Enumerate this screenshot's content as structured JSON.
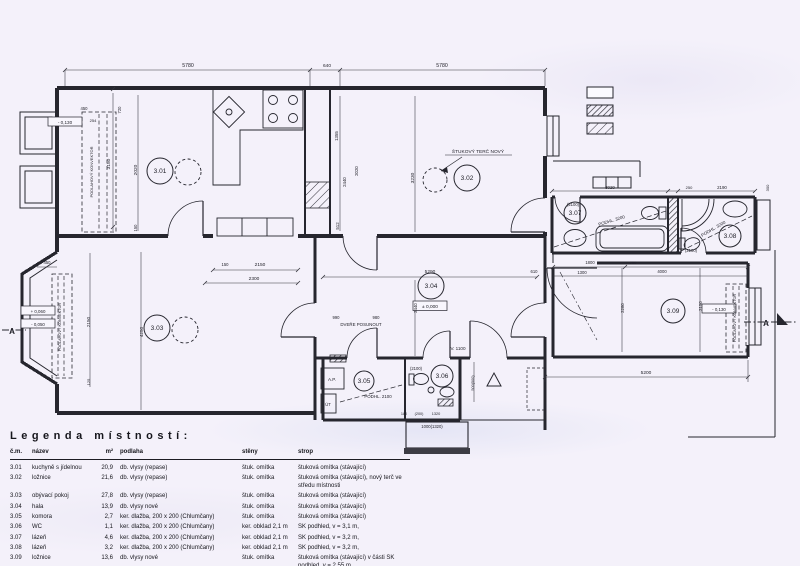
{
  "colors": {
    "background": "#f4f1fa",
    "ink": "#26262e",
    "dark_fill": "#3c3c44"
  },
  "plan": {
    "rooms": [
      {
        "num": "3.01",
        "x": 160,
        "y": 173,
        "r": 13
      },
      {
        "num": "3.02",
        "x": 467,
        "y": 180,
        "r": 13
      },
      {
        "num": "3.03",
        "x": 157,
        "y": 330,
        "r": 13
      },
      {
        "num": "3.04",
        "x": 431,
        "y": 288,
        "r": 13
      },
      {
        "num": "3.05",
        "x": 364,
        "y": 383,
        "r": 10
      },
      {
        "num": "3.06",
        "x": 442,
        "y": 378,
        "r": 11
      },
      {
        "num": "3.07",
        "x": 575,
        "y": 215,
        "r": 11
      },
      {
        "num": "3.08",
        "x": 730,
        "y": 238,
        "r": 11
      },
      {
        "num": "3.09",
        "x": 673,
        "y": 313,
        "r": 12
      }
    ],
    "texts": [
      {
        "n": "dim",
        "t": "5780",
        "x": 188,
        "y": 67
      },
      {
        "n": "dim",
        "t": "640",
        "x": 327,
        "y": 67,
        "s": 4.8
      },
      {
        "n": "dim",
        "t": "5780",
        "x": 442,
        "y": 67
      },
      {
        "n": "level-mark",
        "t": "- 0,130",
        "x": 65,
        "y": 124,
        "s": 4.6
      },
      {
        "n": "dim",
        "t": "450",
        "x": 84,
        "y": 110,
        "s": 4.2
      },
      {
        "n": "dim",
        "t": "254",
        "x": 93,
        "y": 122,
        "s": 4
      },
      {
        "n": "dim",
        "t": "720",
        "x": 121,
        "y": 110,
        "rot": -90,
        "s": 4.2
      },
      {
        "n": "dim",
        "t": "3150",
        "x": 110,
        "y": 164,
        "rot": -90,
        "s": 4.8
      },
      {
        "n": "dim",
        "t": "2020",
        "x": 137,
        "y": 170,
        "rot": -90,
        "s": 4.8
      },
      {
        "n": "dim",
        "t": "150",
        "x": 137,
        "y": 228,
        "rot": -90,
        "s": 4.2
      },
      {
        "n": "annotation",
        "t": "PODLAHOVÝ KONVEKTOR",
        "x": 93,
        "y": 172,
        "rot": -90,
        "s": 4
      },
      {
        "n": "dim",
        "t": "1355",
        "x": 338,
        "y": 136,
        "rot": -90,
        "s": 4.4
      },
      {
        "n": "dim",
        "t": "2440",
        "x": 346,
        "y": 182,
        "rot": -90,
        "s": 4.4
      },
      {
        "n": "dim",
        "t": "2020",
        "x": 358,
        "y": 171,
        "rot": -90,
        "s": 4.4
      },
      {
        "n": "dim",
        "t": "512",
        "x": 339,
        "y": 226,
        "rot": -90,
        "s": 4.4
      },
      {
        "n": "dim",
        "t": "3230",
        "x": 414,
        "y": 178,
        "rot": -90,
        "s": 4.8
      },
      {
        "n": "annotation",
        "t": "ŠTUKOVÝ TERČ NOVÝ",
        "x": 478,
        "y": 153,
        "s": 4.8
      },
      {
        "n": "dim",
        "t": "150",
        "x": 225,
        "y": 266,
        "s": 4.2
      },
      {
        "n": "dim",
        "t": "2150",
        "x": 260,
        "y": 266,
        "s": 4.8
      },
      {
        "n": "dim",
        "t": "2300",
        "x": 254,
        "y": 280,
        "s": 4.8
      },
      {
        "n": "dim",
        "t": "990",
        "x": 336,
        "y": 319,
        "s": 4.2
      },
      {
        "n": "dim",
        "t": "980",
        "x": 376,
        "y": 319,
        "s": 4.2
      },
      {
        "n": "annotation",
        "t": "DVEŘE POSUNOUT",
        "x": 361,
        "y": 326,
        "s": 4.4
      },
      {
        "n": "dim",
        "t": "5290",
        "x": 430,
        "y": 273,
        "s": 4.8
      },
      {
        "n": "dim",
        "t": "610",
        "x": 534,
        "y": 273,
        "s": 4.2
      },
      {
        "n": "dim",
        "t": "2440",
        "x": 417,
        "y": 308,
        "rot": -90,
        "s": 4.4
      },
      {
        "n": "level-mark",
        "t": "± 0,000",
        "x": 430,
        "y": 308,
        "s": 4.8
      },
      {
        "n": "annotation",
        "t": "V. 1100",
        "x": 458,
        "y": 350,
        "s": 4.6
      },
      {
        "n": "dim",
        "t": "(2100)",
        "x": 416,
        "y": 370,
        "s": 4.2
      },
      {
        "n": "annotation",
        "t": "PODHL. 2100",
        "x": 378,
        "y": 398,
        "s": 4.4
      },
      {
        "n": "dim",
        "t": "180",
        "x": 404,
        "y": 415,
        "s": 3.8
      },
      {
        "n": "dim",
        "t": "(200)",
        "x": 419,
        "y": 415,
        "s": 3.8
      },
      {
        "n": "dim",
        "t": "1320",
        "x": 436,
        "y": 415,
        "s": 3.8
      },
      {
        "n": "dim",
        "t": "1000(1320)",
        "x": 432,
        "y": 428,
        "s": 4.2
      },
      {
        "n": "annotation",
        "t": "A.P.",
        "x": 332,
        "y": 381,
        "s": 4.6
      },
      {
        "n": "annotation",
        "t": "ÚT",
        "x": 328,
        "y": 406,
        "s": 4.2
      },
      {
        "n": "level-mark",
        "t": "+ 0,060",
        "x": 38,
        "y": 313,
        "s": 4.4
      },
      {
        "n": "level-mark",
        "t": "- 0,050",
        "x": 38,
        "y": 326,
        "s": 4.4
      },
      {
        "n": "section-mark",
        "t": "A",
        "x": 12,
        "y": 334,
        "s": 8,
        "b": 1
      },
      {
        "n": "annotation",
        "t": "PODLAHOVÝ KONVEKTOR",
        "x": 61,
        "y": 327,
        "rot": -90,
        "s": 3.8
      },
      {
        "n": "dim",
        "t": "450",
        "x": 47,
        "y": 264,
        "s": 4.2
      },
      {
        "n": "dim",
        "t": "2150",
        "x": 90,
        "y": 322,
        "rot": -90,
        "s": 4.6
      },
      {
        "n": "dim",
        "t": "125",
        "x": 90,
        "y": 382,
        "rot": -90,
        "s": 4
      },
      {
        "n": "dim",
        "t": "4250",
        "x": 143,
        "y": 332,
        "rot": -90,
        "s": 4.6
      },
      {
        "n": "dim",
        "t": "3020",
        "x": 610,
        "y": 189,
        "s": 4.4
      },
      {
        "n": "dim",
        "t": "250",
        "x": 689,
        "y": 189,
        "s": 4
      },
      {
        "n": "dim",
        "t": "2190",
        "x": 722,
        "y": 189,
        "s": 4.4
      },
      {
        "n": "dim",
        "t": "300",
        "x": 769,
        "y": 188,
        "rot": -90,
        "s": 4
      },
      {
        "n": "dim",
        "t": "(2100)",
        "x": 573,
        "y": 206,
        "s": 4.2
      },
      {
        "n": "annotation",
        "t": "PODHL. 3200",
        "x": 612,
        "y": 222,
        "rot": -17,
        "s": 4.4
      },
      {
        "n": "annotation",
        "t": "PODHL. 3200",
        "x": 714,
        "y": 230,
        "rot": -30,
        "s": 4.4
      },
      {
        "n": "dim",
        "t": "(2100)",
        "x": 691,
        "y": 252,
        "s": 4.2
      },
      {
        "n": "dim",
        "t": "1800",
        "x": 590,
        "y": 264,
        "s": 4.2
      },
      {
        "n": "dim",
        "t": "250",
        "x": 633,
        "y": 264,
        "s": 4
      },
      {
        "n": "dim",
        "t": "4000",
        "x": 662,
        "y": 273,
        "s": 4.2
      },
      {
        "n": "dim",
        "t": "1300",
        "x": 582,
        "y": 274,
        "s": 4.2
      },
      {
        "n": "dim",
        "t": "2280",
        "x": 624,
        "y": 308,
        "rot": -90,
        "s": 4.4
      },
      {
        "n": "dim",
        "t": "2150",
        "x": 702,
        "y": 306,
        "rot": -90,
        "s": 4.4
      },
      {
        "n": "level-mark",
        "t": "- 0,130",
        "x": 719,
        "y": 311,
        "s": 4.4
      },
      {
        "n": "annotation",
        "t": "PODLAHOVÝ KONVEKTOR",
        "x": 736,
        "y": 318,
        "rot": -90,
        "s": 3.8
      },
      {
        "n": "dim",
        "t": "5200",
        "x": 646,
        "y": 374,
        "s": 4.8
      },
      {
        "n": "section-mark",
        "t": "A",
        "x": 766,
        "y": 326,
        "s": 8,
        "b": 1
      },
      {
        "n": "dim",
        "t": "500(500)",
        "x": 474,
        "y": 383,
        "rot": -90,
        "s": 3.8
      }
    ],
    "swatches": [
      {
        "name": "swatch-existing-plain"
      },
      {
        "name": "swatch-hatch-dense"
      },
      {
        "name": "swatch-hatch-light"
      }
    ]
  },
  "legend": {
    "title": "Legenda místností:",
    "columns": [
      "č.m.",
      "název",
      "m²",
      "podlaha",
      "stěny",
      "strop"
    ],
    "rows": [
      [
        "3.01",
        "kuchyně s jídelnou",
        "20,9",
        "db. vlysy (repase)",
        "štuk. omítka",
        "štuková omítka (stávající)"
      ],
      [
        "3.02",
        "ložnice",
        "21,6",
        "db. vlysy (repase)",
        "štuk. omítka",
        "štuková omítka (stávající), nový terč ve středu místnosti"
      ],
      [
        "3.03",
        "obývací pokoj",
        "27,8",
        "db. vlysy (repase)",
        "štuk. omítka",
        "štuková omítka (stávající)"
      ],
      [
        "3.04",
        "hala",
        "13,9",
        "db. vlysy nové",
        "štuk. omítka",
        "štuková omítka (stávající)"
      ],
      [
        "3.05",
        "komora",
        "2,7",
        "ker. dlažba, 200 x 200 (Chlumčany)",
        "štuk. omítka",
        "štuková omítka (stávající)"
      ],
      [
        "3.06",
        "WC",
        "1,1",
        "ker. dlažba, 200 x 200 (Chlumčany)",
        "ker. obklad 2,1 m",
        "SK podhled, v = 3,1 m,"
      ],
      [
        "3.07",
        "lázeň",
        "4,6",
        "ker. dlažba, 200 x 200 (Chlumčany)",
        "ker. obklad 2,1 m",
        "SK podhled, v = 3,2 m,"
      ],
      [
        "3.08",
        "lázeň",
        "3,2",
        "ker. dlažba, 200 x 200 (Chlumčany)",
        "ker. obklad 2,1 m",
        "SK podhled, v = 3,2 m,"
      ],
      [
        "3.09",
        "ložnice",
        "13,6",
        "db. vlysy nové",
        "štuk. omítka",
        "štuková omítka (stávající) v části SK podhled, v = 2,55 m"
      ]
    ]
  }
}
